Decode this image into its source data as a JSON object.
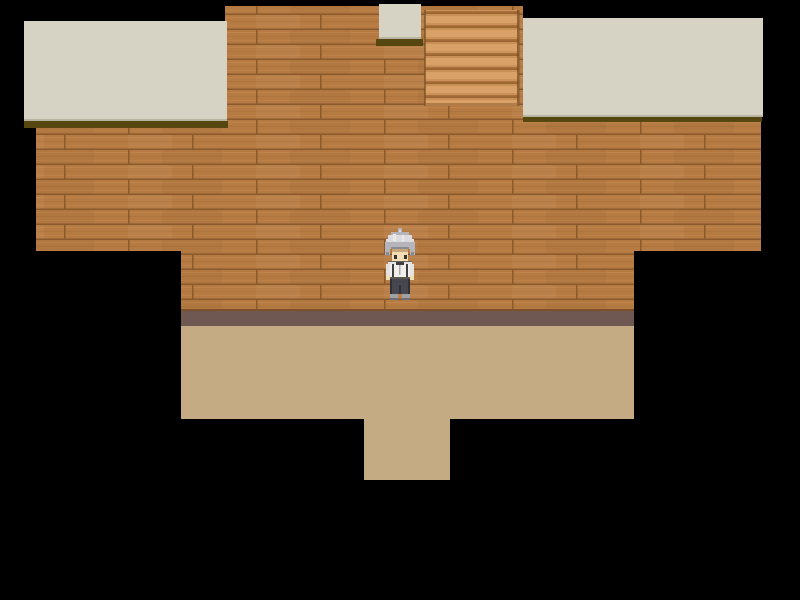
{
  "scene": {
    "description": "Top-down RPG interior room: wooden plank wall, beige ceiling ledges, staircase strip at top, tan floor with south exit, black void around map",
    "character": {
      "name": "gray-haired-villager",
      "facing": "down",
      "position": {
        "x": 385,
        "y": 228,
        "width": 30,
        "height": 72
      }
    },
    "regions": [
      {
        "label": "ceiling-ledge-left"
      },
      {
        "label": "ceiling-ledge-small-top"
      },
      {
        "label": "ceiling-ledge-right"
      },
      {
        "label": "wood-plank-wall"
      },
      {
        "label": "staircase-strip"
      },
      {
        "label": "wall-baseboard"
      },
      {
        "label": "floor-area"
      },
      {
        "label": "floor-exit-south"
      },
      {
        "label": "void"
      }
    ]
  },
  "colors": {
    "bg": "#000000",
    "wood_base": "#b67b43",
    "wood_seam": "#8a592c",
    "wood_light": "#c2884e",
    "wood_dark": "#a86f39",
    "ceiling": "#d6d3c5",
    "ceiling_edge": "#b8b4a2",
    "ceiling_shadow": "#564711",
    "stairs_light": "#d9a067",
    "stairs_mid": "#c89057",
    "stairs_line": "#aa7038",
    "stairs_dark": "#9a6430",
    "stairs_edge": "#7a5226",
    "band": "#6e5851",
    "band_seam": "#7c5128",
    "floor": "#c4ab83",
    "hair": "#b4b4ba",
    "hair_light": "#dcdce0",
    "skin": "#f2dcb4",
    "shirt": "#f0efec",
    "pants": "#46464f",
    "shoes": "#a0a0a5"
  }
}
